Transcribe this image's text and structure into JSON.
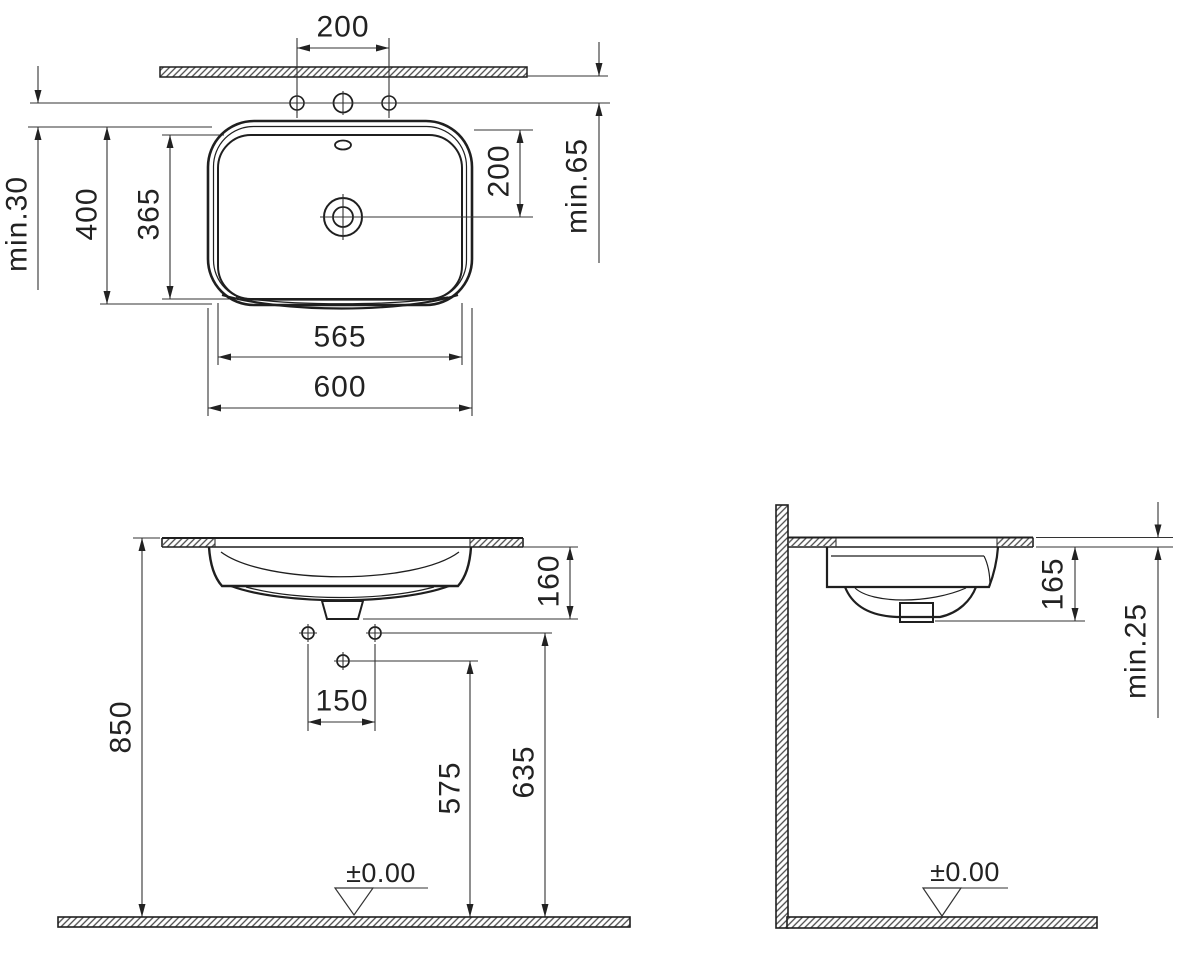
{
  "plan_view": {
    "tap_hole_spacing": "200",
    "drain_from_rim": "200",
    "wall_to_taps": "min.65",
    "taps_to_basin": "min.30",
    "outer_depth": "400",
    "bowl_depth": "365",
    "bowl_width": "565",
    "outer_width": "600"
  },
  "front_view": {
    "counter_height": "850",
    "basin_below_counter": "160",
    "supply_spacing": "150",
    "drain_outlet_height": "575",
    "supply_height": "635",
    "floor_datum": "±0.00"
  },
  "side_view": {
    "basin_below_counter": "165",
    "counter_thickness": "min.25",
    "floor_datum": "±0.00"
  }
}
